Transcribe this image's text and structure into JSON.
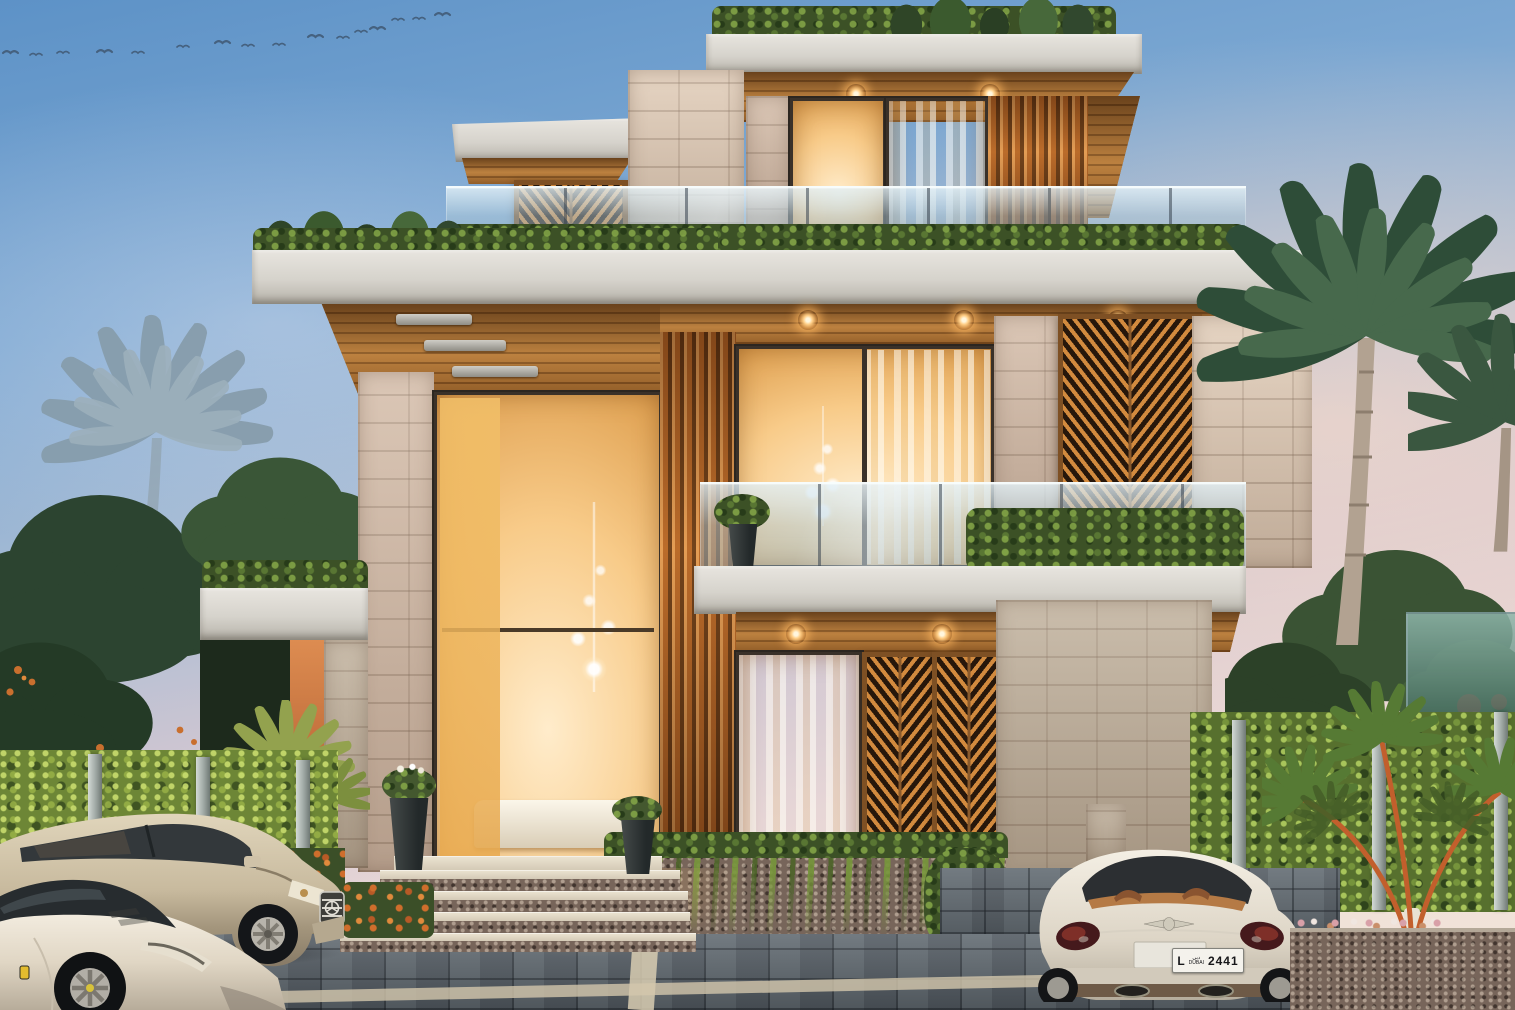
{
  "scene": {
    "title": "Modern luxury villa exterior at dusk",
    "style": "photorealistic architectural rendering",
    "time_of_day": "dusk",
    "location_hint": "Dubai"
  },
  "license_plate": {
    "prefix": "L",
    "city_arabic": "دبي",
    "city_english": "DUBAI",
    "number": "2441"
  },
  "birds": {
    "count": 16,
    "positions": [
      [
        3,
        53
      ],
      [
        30,
        55
      ],
      [
        57,
        53
      ],
      [
        97,
        52
      ],
      [
        132,
        53
      ],
      [
        177,
        47
      ],
      [
        215,
        43
      ],
      [
        242,
        46
      ],
      [
        273,
        45
      ],
      [
        308,
        37
      ],
      [
        337,
        38
      ],
      [
        355,
        32
      ],
      [
        370,
        29
      ],
      [
        392,
        20
      ],
      [
        413,
        19
      ],
      [
        435,
        15
      ]
    ]
  },
  "vehicles": [
    {
      "name": "ferrari-sports-car",
      "body_color": "#efe8dc",
      "position": "foreground left, front three-quarter"
    },
    {
      "name": "mercedes-suv",
      "body_color": "#cfc2a8",
      "position": "left, behind sports car"
    },
    {
      "name": "bentley-coupe",
      "body_color": "#efeae0",
      "position": "right, rear view with Dubai plate"
    }
  ],
  "palette": {
    "sky_top": "#5d92c7",
    "sky_horizon": "#f0e1d8",
    "concrete_slab": "#d6d3cc",
    "timber_slats": "#b26224",
    "stone_cladding": "#cdb6a4",
    "window_glow": "#f8cb89",
    "hedge_green": "#3c5126",
    "ivy_green": "#6d8636",
    "driveway_paver": "#5b646c",
    "palm_frond": "#2e4d38"
  },
  "architecture": {
    "storeys": 3,
    "features": [
      "rooftop hedge planters",
      "glass balustrades",
      "herringbone timber screens",
      "vertical timber fin slats",
      "double-height glazed entrance",
      "recessed soffit downlights",
      "stone clad piers",
      "cascading vine wall",
      "paved driveway",
      "entry steps with flower beds"
    ]
  }
}
